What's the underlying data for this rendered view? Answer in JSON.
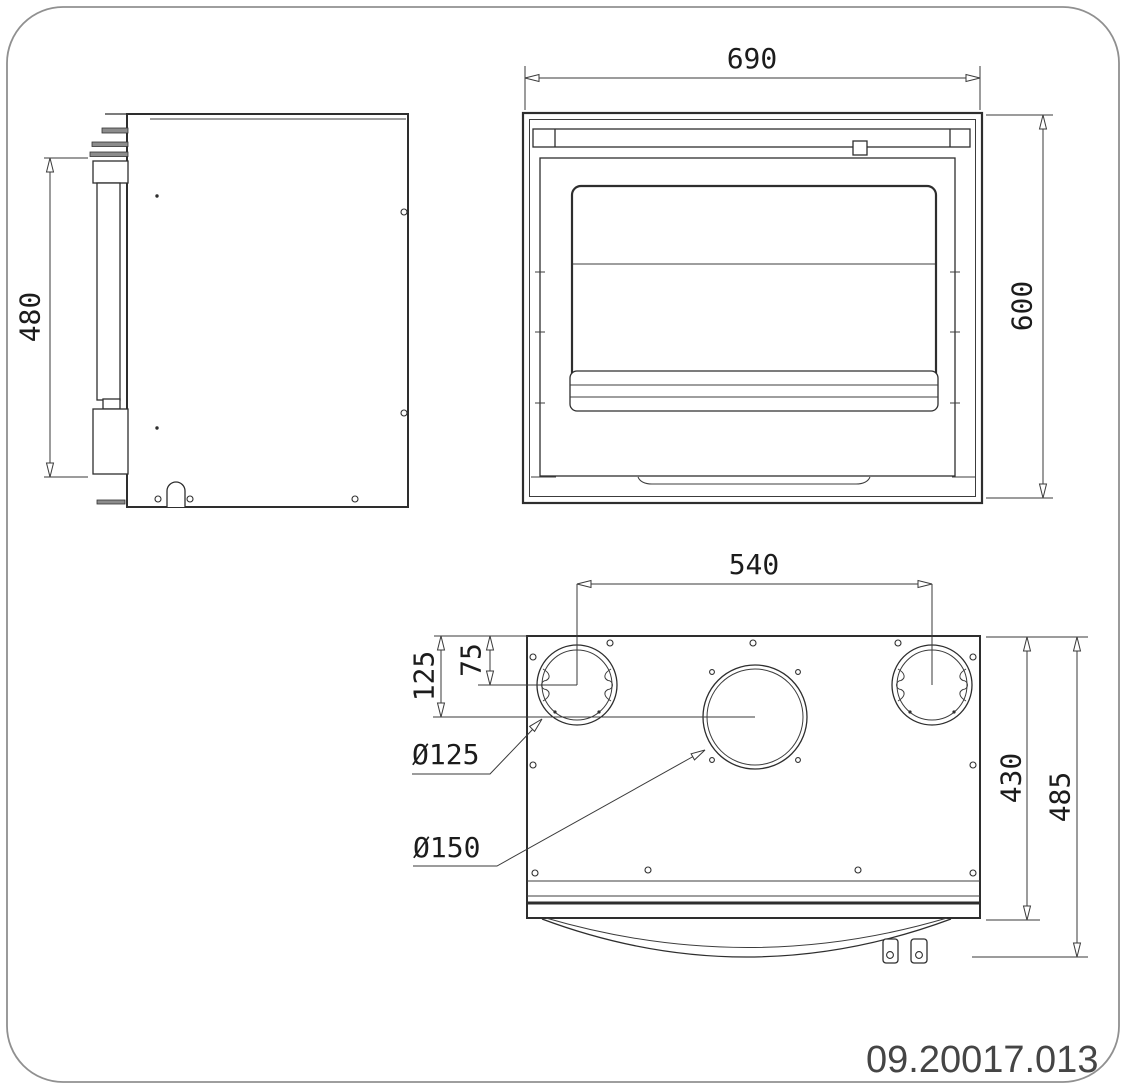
{
  "drawing_number": "09.20017.013",
  "dims": {
    "front_width": "690",
    "front_height": "600",
    "side_height": "480",
    "flue_spacing": "540",
    "offset_large": "125",
    "offset_small": "75",
    "dia_small": "Ø125",
    "dia_large": "Ø150",
    "depth_body": "430",
    "depth_overall": "485"
  },
  "colors": {
    "background": "#ffffff",
    "outline": "#2e2e2e",
    "dimension_line": "#3a3a3a",
    "page_border": "#909090",
    "metal_fill": "#8c8c8c",
    "drawing_number_text": "#454545"
  }
}
